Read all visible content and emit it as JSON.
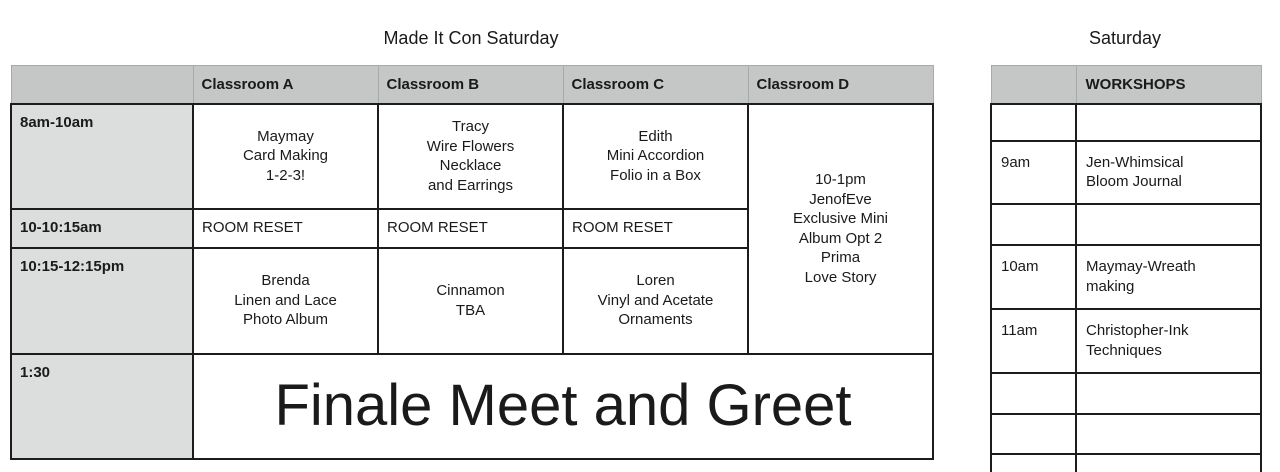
{
  "colors": {
    "header_bg": "#c4c7c5",
    "time_bg": "#dcdedd",
    "border": "#1c1c1c",
    "text": "#1a1a1a",
    "page_bg": "#ffffff"
  },
  "left_table": {
    "title": "Made It Con Saturday",
    "header": {
      "corner": "",
      "col_a": "Classroom A",
      "col_b": "Classroom B",
      "col_c": "Classroom C",
      "col_d": "Classroom D"
    },
    "rows": {
      "r1": {
        "time": "8am-10am",
        "a": "Maymay\nCard Making\n1-2-3!",
        "b": "Tracy\nWire Flowers\nNecklace\nand Earrings",
        "c": "Edith\nMini Accordion\nFolio in a Box"
      },
      "d_span": "10-1pm\nJenofEve\nExclusive Mini\nAlbum Opt 2\nPrima\nLove Story",
      "r2": {
        "time": "10-10:15am",
        "a": "ROOM RESET",
        "b": "ROOM RESET",
        "c": "ROOM RESET"
      },
      "r3": {
        "time": "10:15-12:15pm",
        "a": "Brenda\nLinen and Lace\nPhoto Album",
        "b": "Cinnamon\nTBA",
        "c": "Loren\nVinyl and Acetate\nOrnaments"
      },
      "r4": {
        "time": "1:30",
        "finale": "Finale Meet and Greet"
      }
    }
  },
  "right_table": {
    "title": "Saturday",
    "header": {
      "corner": "",
      "label": "WORKSHOPS"
    },
    "rows": [
      {
        "time": "",
        "workshop": ""
      },
      {
        "time": "9am",
        "workshop": "Jen-Whimsical\nBloom Journal"
      },
      {
        "time": "",
        "workshop": ""
      },
      {
        "time": "10am",
        "workshop": "Maymay-Wreath\nmaking"
      },
      {
        "time": "11am",
        "workshop": "Christopher-Ink\nTechniques"
      },
      {
        "time": "",
        "workshop": ""
      },
      {
        "time": "",
        "workshop": ""
      },
      {
        "time": "",
        "workshop": ""
      }
    ]
  }
}
